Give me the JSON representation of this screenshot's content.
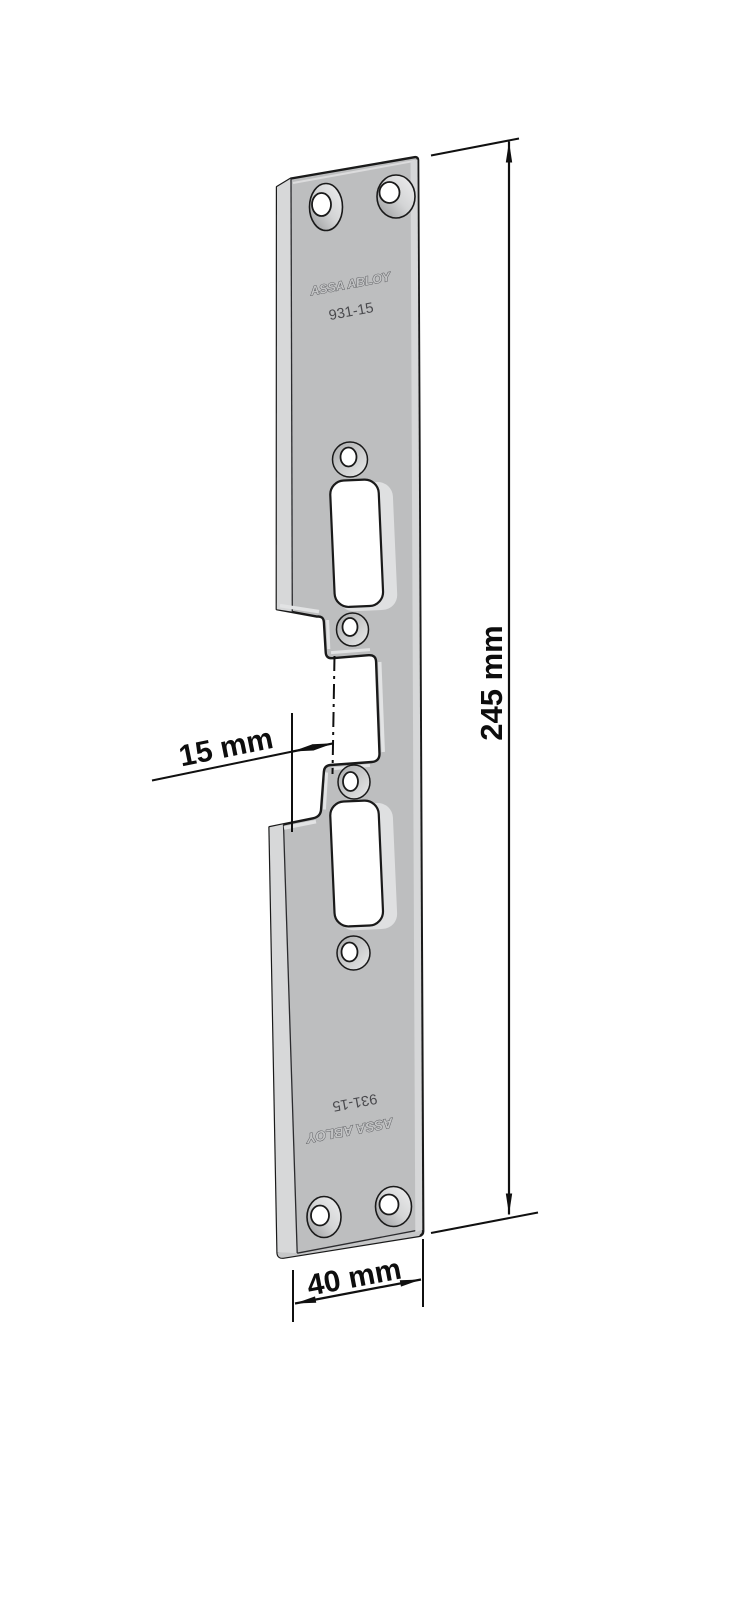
{
  "page": {
    "background": "#ffffff"
  },
  "drawing": {
    "kind": "technical-drawing",
    "product": {
      "brand": "ASSA ABLOY",
      "model": "931-15"
    },
    "dimensions": {
      "overall_height": "245 mm",
      "center_offset": "15 mm",
      "plate_width": "40 mm"
    },
    "colors": {
      "plate_front": "#bdbebf",
      "plate_side": "#d7d8d9",
      "plate_bottom_face": "#c6c7c8",
      "cut_bevel": "#dfe0e1",
      "outline": "#1a1a1a",
      "dimension_ink": "#101010",
      "background": "#ffffff"
    }
  }
}
